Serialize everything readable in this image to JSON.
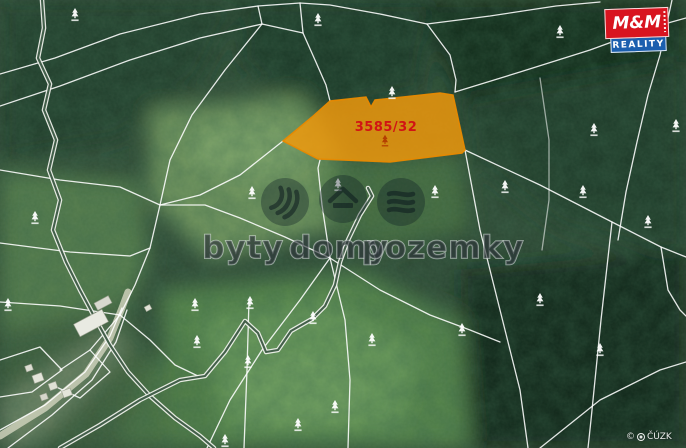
{
  "map": {
    "type": "cadastral-aerial-map",
    "parcel": {
      "label": "3585/32",
      "fill_color": "#f49a0a",
      "border_color": "#e88900",
      "label_color": "#d11414"
    },
    "watermark": {
      "words": [
        "byty",
        "domy",
        "pozemky"
      ],
      "icons": [
        "apartments-icon",
        "house-icon",
        "land-icon"
      ]
    },
    "logo": {
      "line1": "M&M",
      "line2": "REALITY",
      "red_color": "#d8141f",
      "blue_color": "#1b5fae"
    },
    "copyright": {
      "symbol": "©",
      "text": "ČÚZK"
    },
    "tree_symbols": [
      [
        75,
        15
      ],
      [
        318,
        20
      ],
      [
        392,
        93
      ],
      [
        560,
        32
      ],
      [
        594,
        130
      ],
      [
        648,
        222
      ],
      [
        676,
        126
      ],
      [
        252,
        193
      ],
      [
        338,
        185
      ],
      [
        435,
        192
      ],
      [
        505,
        187
      ],
      [
        583,
        192
      ],
      [
        8,
        305
      ],
      [
        35,
        218
      ],
      [
        195,
        305
      ],
      [
        250,
        303
      ],
      [
        197,
        342
      ],
      [
        248,
        362
      ],
      [
        313,
        318
      ],
      [
        372,
        340
      ],
      [
        298,
        425
      ],
      [
        335,
        407
      ],
      [
        225,
        441
      ],
      [
        462,
        330
      ],
      [
        540,
        300
      ],
      [
        600,
        350
      ]
    ],
    "red_tree_symbol": [
      385,
      141
    ]
  }
}
